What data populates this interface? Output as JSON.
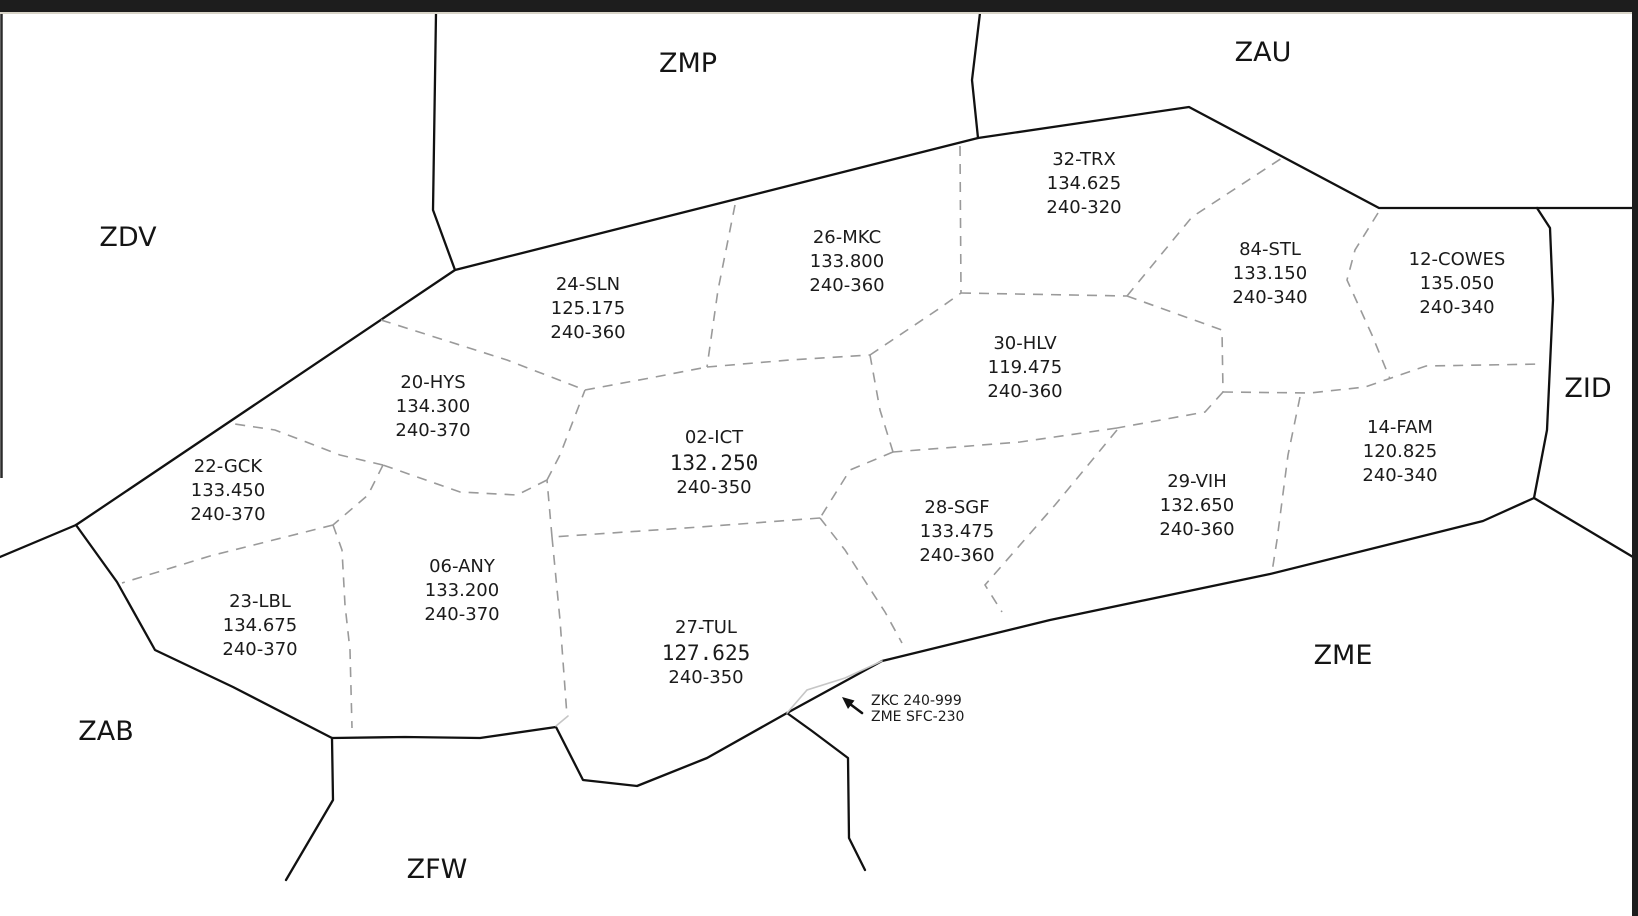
{
  "map": {
    "description": "ZKC high altitude sector map",
    "adjacent_centers": [
      {
        "id": "ZDV",
        "x": 128,
        "y": 238
      },
      {
        "id": "ZMP",
        "x": 688,
        "y": 64
      },
      {
        "id": "ZAU",
        "x": 1263,
        "y": 53
      },
      {
        "id": "ZID",
        "x": 1588,
        "y": 389
      },
      {
        "id": "ZME",
        "x": 1343,
        "y": 656
      },
      {
        "id": "ZAB",
        "x": 106,
        "y": 732
      },
      {
        "id": "ZFW",
        "x": 437,
        "y": 870
      }
    ],
    "sectors": [
      {
        "name": "24-SLN",
        "frequency": "125.175",
        "altitude_range": "240-360",
        "x": 588,
        "y": 285,
        "freq_mono": false
      },
      {
        "name": "26-MKC",
        "frequency": "133.800",
        "altitude_range": "240-360",
        "x": 847,
        "y": 238,
        "freq_mono": false
      },
      {
        "name": "32-TRX",
        "frequency": "134.625",
        "altitude_range": "240-320",
        "x": 1084,
        "y": 160,
        "freq_mono": false
      },
      {
        "name": "84-STL",
        "frequency": "133.150",
        "altitude_range": "240-340",
        "x": 1270,
        "y": 250,
        "freq_mono": false
      },
      {
        "name": "12-COWES",
        "frequency": "135.050",
        "altitude_range": "240-340",
        "x": 1457,
        "y": 260,
        "freq_mono": false
      },
      {
        "name": "20-HYS",
        "frequency": "134.300",
        "altitude_range": "240-370",
        "x": 433,
        "y": 383,
        "freq_mono": false
      },
      {
        "name": "30-HLV",
        "frequency": "119.475",
        "altitude_range": "240-360",
        "x": 1025,
        "y": 344,
        "freq_mono": false
      },
      {
        "name": "02-ICT",
        "frequency": "132.250",
        "altitude_range": "240-350",
        "x": 714,
        "y": 438,
        "freq_mono": true
      },
      {
        "name": "22-GCK",
        "frequency": "133.450",
        "altitude_range": "240-370",
        "x": 228,
        "y": 467,
        "freq_mono": false
      },
      {
        "name": "14-FAM",
        "frequency": "120.825",
        "altitude_range": "240-340",
        "x": 1400,
        "y": 428,
        "freq_mono": false
      },
      {
        "name": "29-VIH",
        "frequency": "132.650",
        "altitude_range": "240-360",
        "x": 1197,
        "y": 482,
        "freq_mono": false
      },
      {
        "name": "28-SGF",
        "frequency": "133.475",
        "altitude_range": "240-360",
        "x": 957,
        "y": 508,
        "freq_mono": false
      },
      {
        "name": "06-ANY",
        "frequency": "133.200",
        "altitude_range": "240-370",
        "x": 462,
        "y": 567,
        "freq_mono": false
      },
      {
        "name": "23-LBL",
        "frequency": "134.675",
        "altitude_range": "240-370",
        "x": 260,
        "y": 602,
        "freq_mono": false
      },
      {
        "name": "27-TUL",
        "frequency": "127.625",
        "altitude_range": "240-350",
        "x": 706,
        "y": 628,
        "freq_mono": true
      }
    ],
    "annotation": {
      "line1": "ZKC 240-999",
      "line2": "ZME SFC-230"
    },
    "colors": {
      "background": "#ffffff",
      "text": "#1b1b1b",
      "boundary_solid": "#111111",
      "boundary_dashed": "#9a9a9a",
      "boundary_light": "#c6c6c6",
      "frame_bar": "#1d1d1d",
      "frame_hairline": "#d8d4c8"
    }
  }
}
